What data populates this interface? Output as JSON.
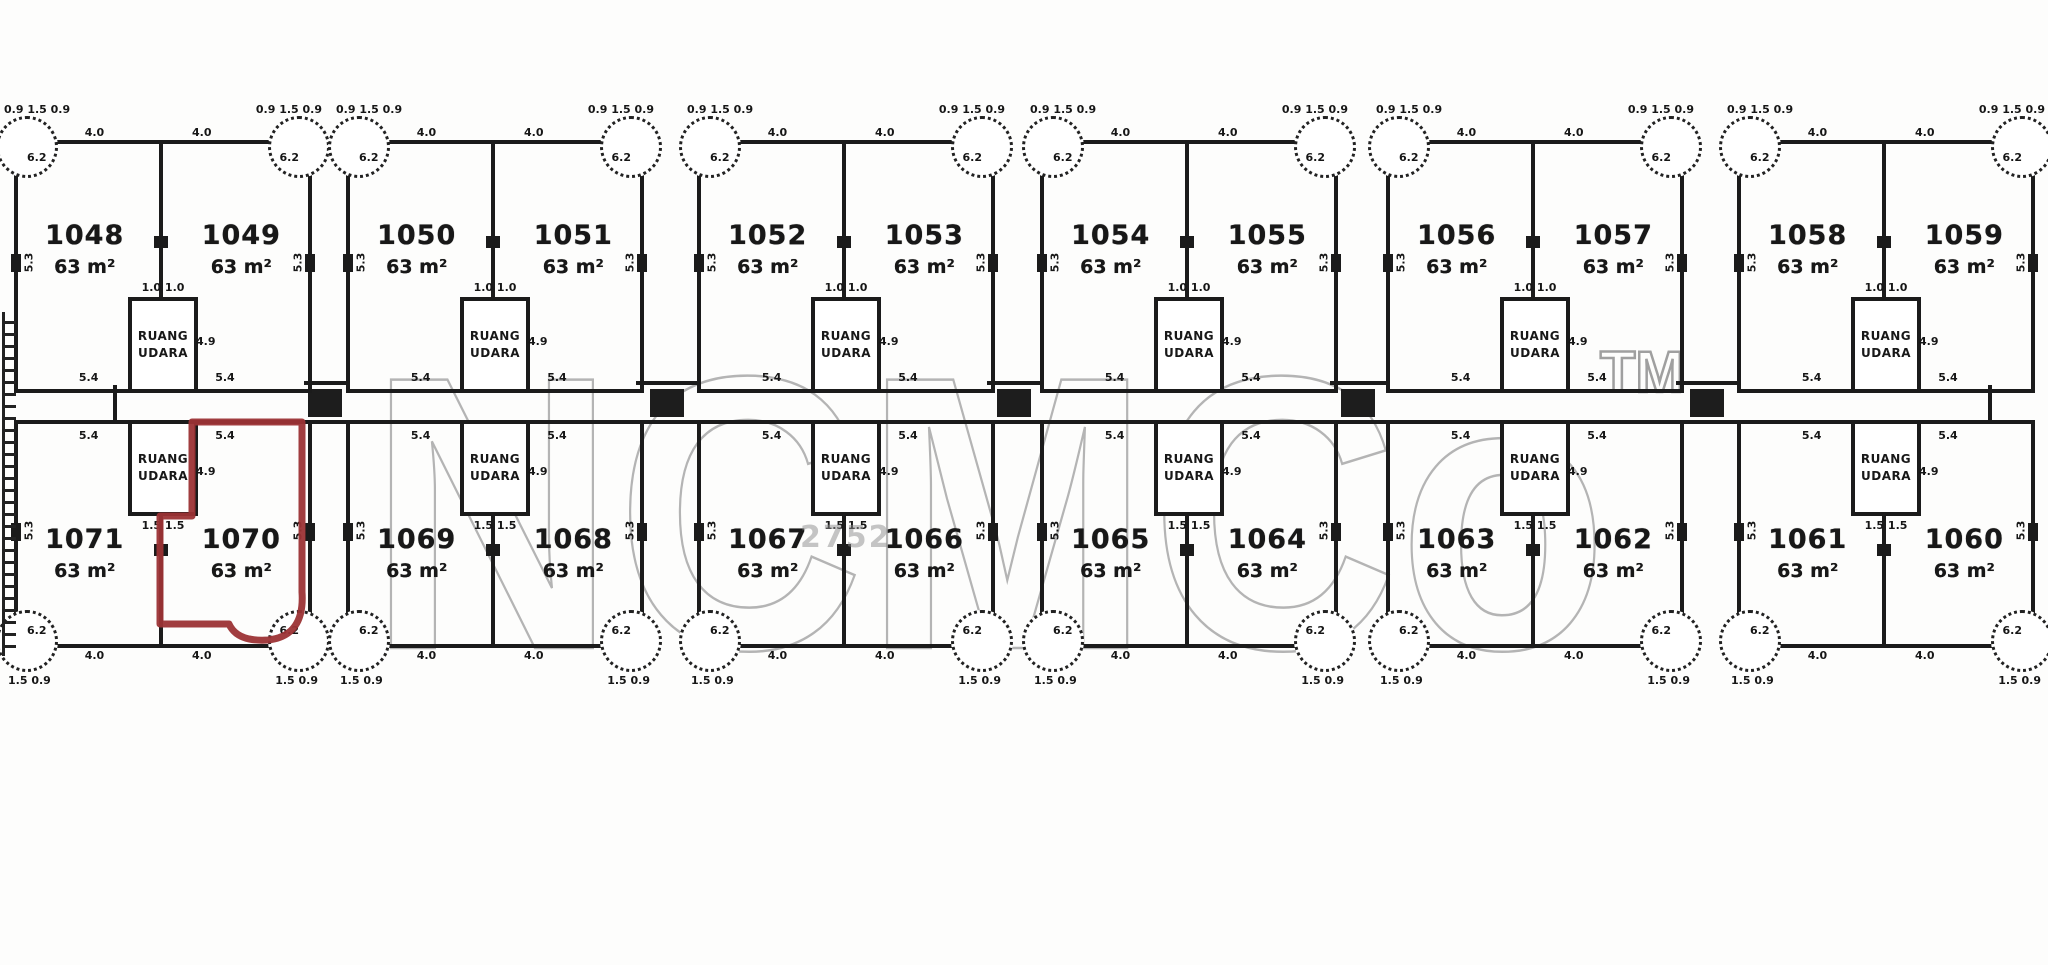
{
  "watermark": {
    "text": "NCMCo",
    "tm": "TM"
  },
  "colors": {
    "ink": "#1b1b1b",
    "highlight": "#9c3335",
    "watermark": "#b4b4b4"
  },
  "air_space": {
    "line1": "RUANG",
    "line2": "UDARA"
  },
  "highlighted_plot": "1070",
  "stamp": {
    "text": "2752"
  },
  "dims": {
    "notch_top": "0.9 1.5 0.9",
    "bottom_notch": "1.5 0.9",
    "edge_top": "4.0",
    "edge_bottom": "4.0",
    "corner_outer": "6.2",
    "side_outer": "5.3",
    "edge_road": "5.4",
    "box_top": "1.0 1.0",
    "box_bottom": "1.5 1.5",
    "box_side": "4.9"
  },
  "rows": [
    {
      "name": "top",
      "pairs": [
        {
          "left": {
            "number": "1048",
            "area": "63 m²"
          },
          "right": {
            "number": "1049",
            "area": "63 m²"
          }
        },
        {
          "left": {
            "number": "1050",
            "area": "63 m²"
          },
          "right": {
            "number": "1051",
            "area": "63 m²"
          }
        },
        {
          "left": {
            "number": "1052",
            "area": "63 m²"
          },
          "right": {
            "number": "1053",
            "area": "63 m²"
          }
        },
        {
          "left": {
            "number": "1054",
            "area": "63 m²"
          },
          "right": {
            "number": "1055",
            "area": "63 m²"
          }
        },
        {
          "left": {
            "number": "1056",
            "area": "63 m²"
          },
          "right": {
            "number": "1057",
            "area": "63 m²"
          }
        },
        {
          "left": {
            "number": "1058",
            "area": "63 m²"
          },
          "right": {
            "number": "1059",
            "area": "63 m²"
          }
        }
      ]
    },
    {
      "name": "bottom",
      "pairs": [
        {
          "left": {
            "number": "1071",
            "area": "63 m²"
          },
          "right": {
            "number": "1070",
            "area": "63 m²",
            "highlighted": true
          }
        },
        {
          "left": {
            "number": "1069",
            "area": "63 m²"
          },
          "right": {
            "number": "1068",
            "area": "63 m²"
          }
        },
        {
          "left": {
            "number": "1067",
            "area": "63 m²"
          },
          "right": {
            "number": "1066",
            "area": "63 m²"
          }
        },
        {
          "left": {
            "number": "1065",
            "area": "63 m²"
          },
          "right": {
            "number": "1064",
            "area": "63 m²"
          }
        },
        {
          "left": {
            "number": "1063",
            "area": "63 m²"
          },
          "right": {
            "number": "1062",
            "area": "63 m²"
          }
        },
        {
          "left": {
            "number": "1061",
            "area": "63 m²"
          },
          "right": {
            "number": "1060",
            "area": "63 m²"
          }
        }
      ]
    }
  ]
}
